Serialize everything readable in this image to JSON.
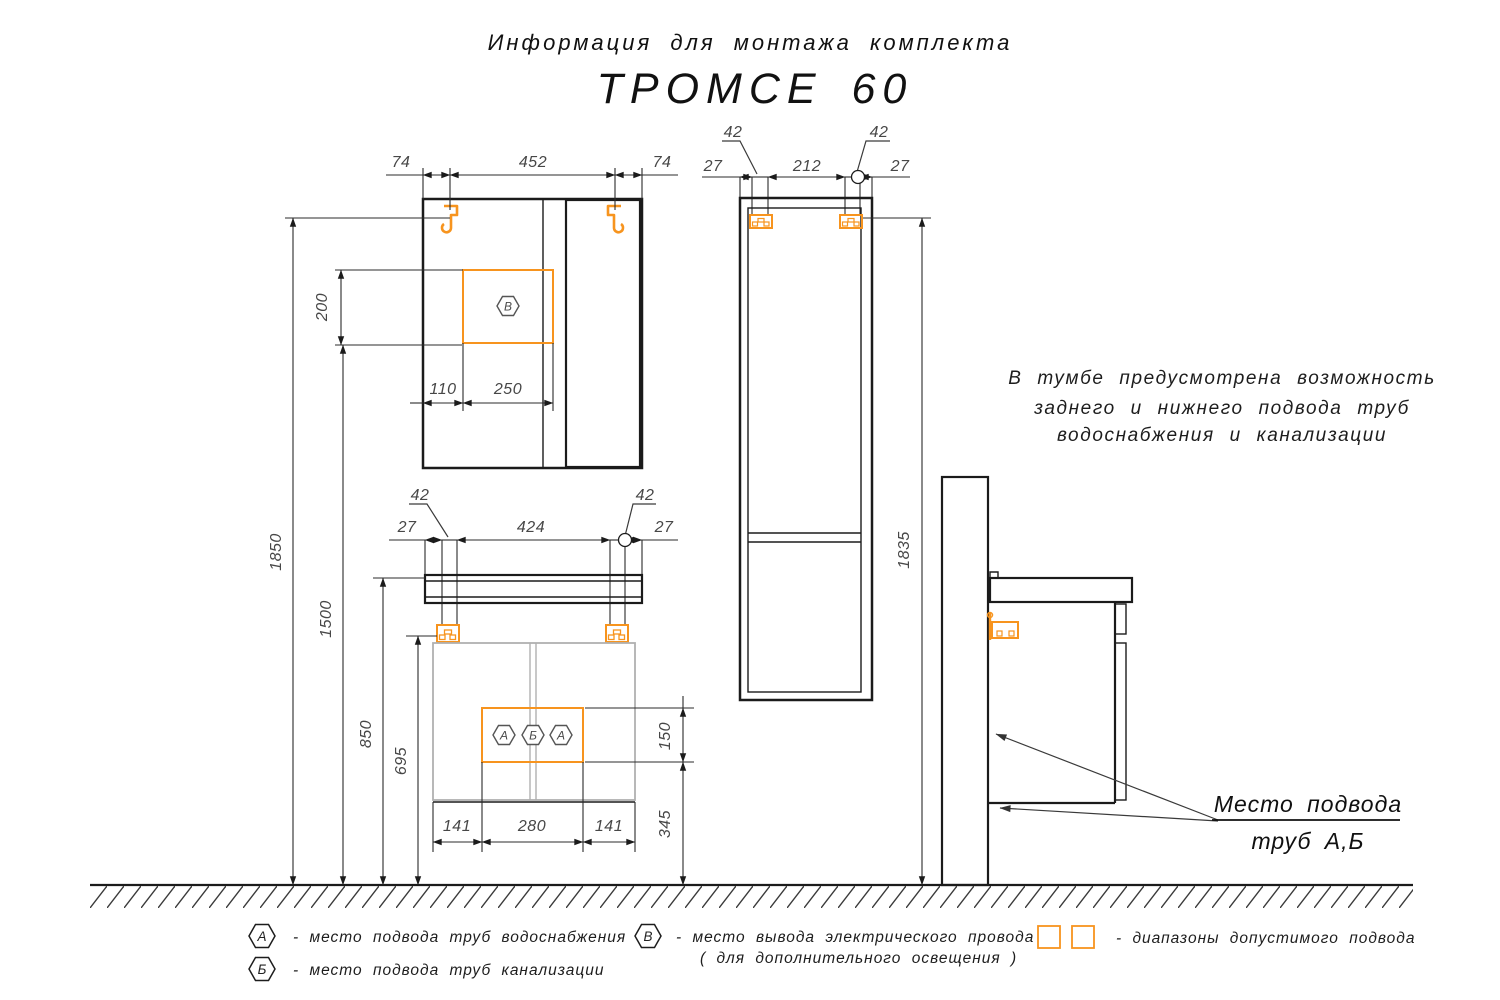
{
  "title": {
    "line1": "Информация для монтажа комплекта",
    "line2": "ТРОМСЕ 60"
  },
  "note": {
    "line1": "В тумбе предусмотрена возможность",
    "line2": "заднего и нижнего подвода труб",
    "line3": "водоснабжения и канализации"
  },
  "callout": {
    "line1": "Место подвода",
    "line2": "труб А,Б"
  },
  "mirror": {
    "dim_top_left": "74",
    "dim_top_center": "452",
    "dim_top_right": "74",
    "dim_outlet_height": "200",
    "dim_outlet_offset": "110",
    "dim_outlet_width": "250",
    "dim_hooks_from_floor": "1850",
    "dim_outlet_from_floor": "1500",
    "outlet_symbol": "В"
  },
  "vanity": {
    "dim_hook_left": "42",
    "dim_hook_right": "42",
    "dim_edge_left": "27",
    "dim_hook_span": "424",
    "dim_edge_right": "27",
    "dim_rail_from_floor": "850",
    "dim_bracket_from_floor": "695",
    "dim_zone_height": "150",
    "dim_zone_from_floor": "345",
    "dim_zone_left": "141",
    "dim_zone_width": "280",
    "dim_zone_right": "141",
    "zone_symbols": [
      "А",
      "Б",
      "А"
    ]
  },
  "tall": {
    "dim_hook_left": "42",
    "dim_hook_right": "42",
    "dim_edge_left": "27",
    "dim_hook_span": "212",
    "dim_edge_right": "27",
    "dim_hooks_from_floor": "1835"
  },
  "legend": {
    "item_a_symbol": "А",
    "item_a_text": "-  место подвода труб водоснабжения",
    "item_b_symbol": "Б",
    "item_b_text": "-  место подвода труб канализации",
    "item_v_symbol": "В",
    "item_v_text": "-  место вывода электрического провода",
    "item_v_text2": "( для дополнительного освещения )",
    "item_hatch_text": "-  диапазоны допустимого подвода"
  },
  "colors": {
    "accent_orange": "#F7941E",
    "line_black": "#1B1B1B",
    "dim_gray": "#474747",
    "body_gray": "#B0B0B0"
  }
}
